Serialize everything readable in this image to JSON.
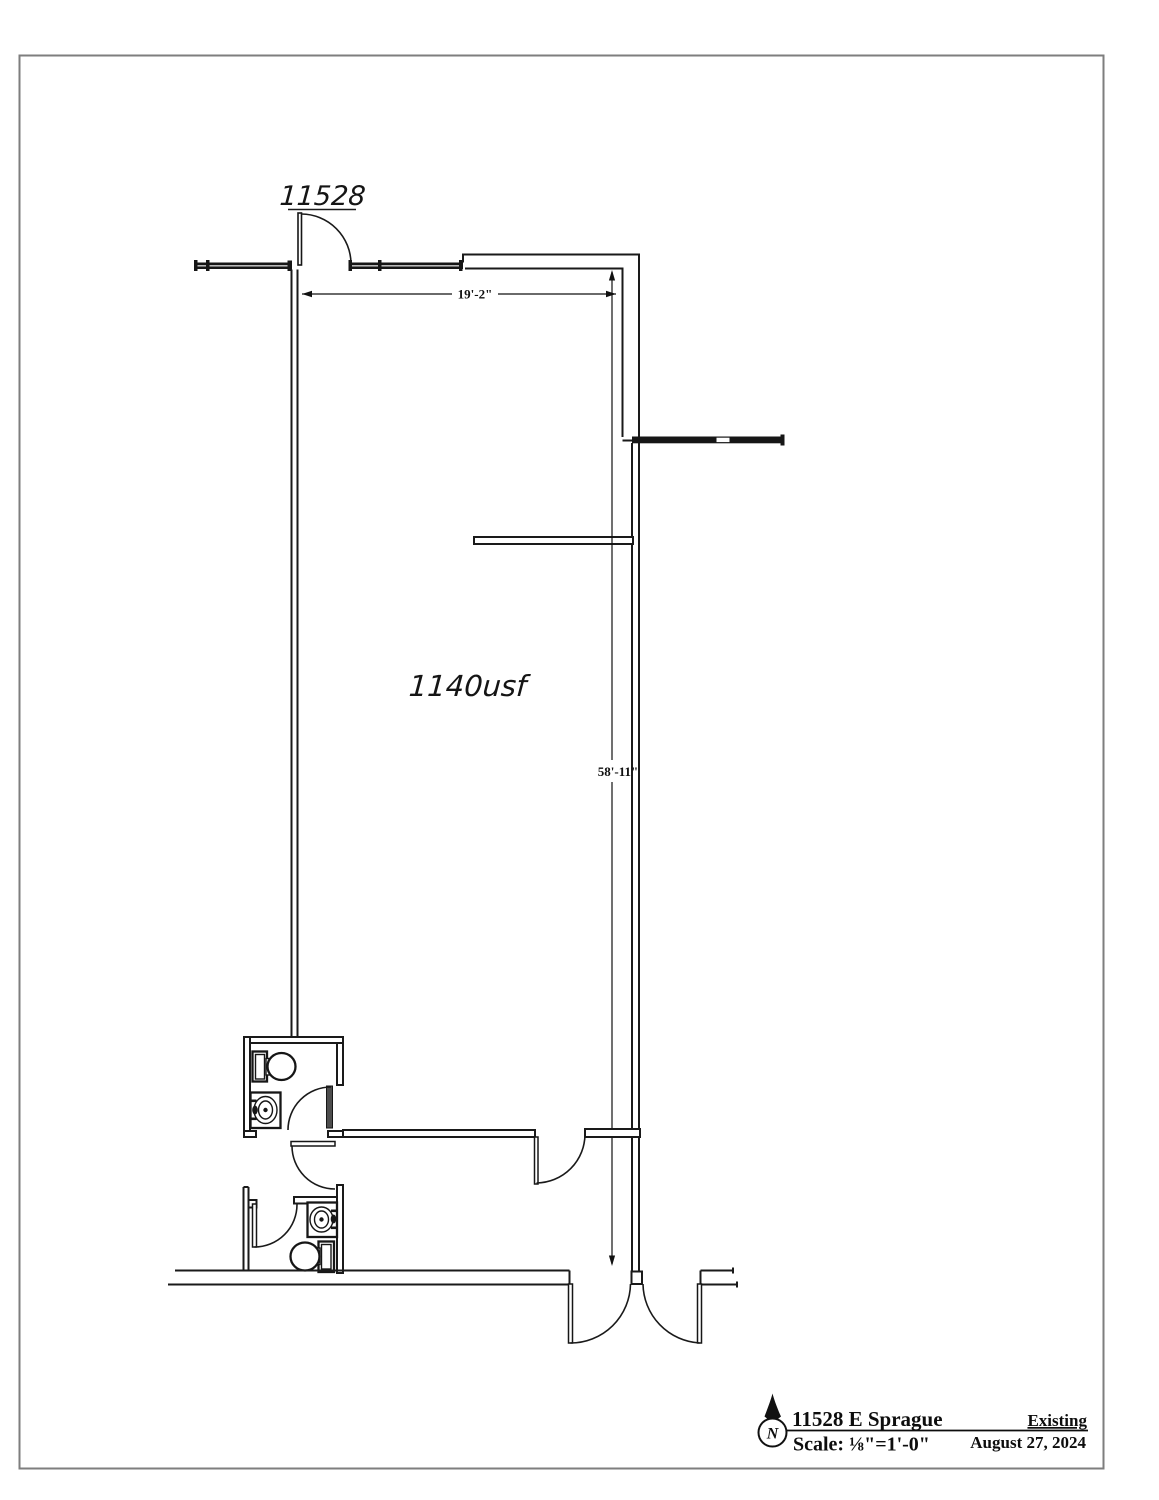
{
  "plan": {
    "unit_label": "11528",
    "area_label": "1140usf",
    "dim_width": "19'-2\"",
    "dim_height": "58'-11\""
  },
  "title_block": {
    "north": "N",
    "address": "11528 E Sprague",
    "scale": "Scale: ⅛\"=1'-0\"",
    "status": "Existing",
    "date": "August 27, 2024"
  }
}
